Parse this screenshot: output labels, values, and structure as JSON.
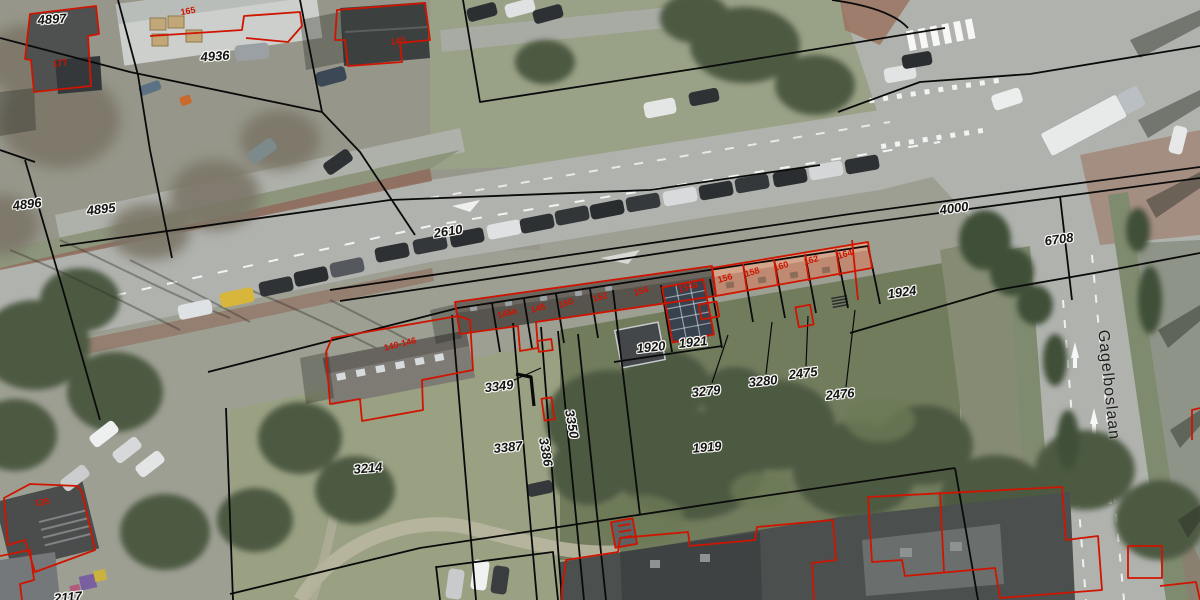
{
  "map": {
    "street_name": "Gagelboslaan",
    "street_name_rotation_deg": 84,
    "parcel_numbers": [
      {
        "text": "4897",
        "x": 52,
        "y": 19,
        "rot": -4
      },
      {
        "text": "4936",
        "x": 215,
        "y": 56,
        "rot": -4
      },
      {
        "text": "4896",
        "x": 27,
        "y": 204,
        "rot": -7
      },
      {
        "text": "4895",
        "x": 101,
        "y": 209,
        "rot": -7
      },
      {
        "text": "2610",
        "x": 448,
        "y": 231,
        "rot": -9
      },
      {
        "text": "4000",
        "x": 954,
        "y": 208,
        "rot": -8
      },
      {
        "text": "6708",
        "x": 1059,
        "y": 239,
        "rot": -8
      },
      {
        "text": "1924",
        "x": 902,
        "y": 292,
        "rot": -8
      },
      {
        "text": "1920",
        "x": 651,
        "y": 347,
        "rot": -6
      },
      {
        "text": "1921",
        "x": 693,
        "y": 342,
        "rot": -6
      },
      {
        "text": "3279",
        "x": 706,
        "y": 391,
        "rot": -6
      },
      {
        "text": "3280",
        "x": 763,
        "y": 381,
        "rot": -6
      },
      {
        "text": "2475",
        "x": 803,
        "y": 373,
        "rot": -7
      },
      {
        "text": "2476",
        "x": 840,
        "y": 394,
        "rot": -6
      },
      {
        "text": "1919",
        "x": 707,
        "y": 447,
        "rot": -5
      },
      {
        "text": "3349",
        "x": 499,
        "y": 386,
        "rot": -7
      },
      {
        "text": "3387",
        "x": 508,
        "y": 447,
        "rot": -6
      },
      {
        "text": "3386",
        "x": 546,
        "y": 452,
        "rot": 80
      },
      {
        "text": "3350",
        "x": 572,
        "y": 424,
        "rot": 80
      },
      {
        "text": "3214",
        "x": 368,
        "y": 468,
        "rot": -5
      },
      {
        "text": "2117",
        "x": 68,
        "y": 597,
        "rot": -5
      }
    ],
    "house_numbers": [
      {
        "text": "165",
        "x": 188,
        "y": 11,
        "rot": -10
      },
      {
        "text": "177",
        "x": 60,
        "y": 63,
        "rot": -8
      },
      {
        "text": "140",
        "x": 398,
        "y": 41,
        "rot": -10
      },
      {
        "text": "140-146",
        "x": 400,
        "y": 344,
        "rot": -14
      },
      {
        "text": "146a",
        "x": 507,
        "y": 313,
        "rot": -16
      },
      {
        "text": "148",
        "x": 538,
        "y": 308,
        "rot": -16
      },
      {
        "text": "150",
        "x": 566,
        "y": 303,
        "rot": -16
      },
      {
        "text": "152",
        "x": 600,
        "y": 297,
        "rot": -16
      },
      {
        "text": "154",
        "x": 641,
        "y": 291,
        "rot": -16
      },
      {
        "text": "154a",
        "x": 688,
        "y": 287,
        "rot": -16
      },
      {
        "text": "156",
        "x": 725,
        "y": 278,
        "rot": -16
      },
      {
        "text": "158",
        "x": 752,
        "y": 272,
        "rot": -16
      },
      {
        "text": "160",
        "x": 781,
        "y": 266,
        "rot": -16
      },
      {
        "text": "162",
        "x": 811,
        "y": 260,
        "rot": -16
      },
      {
        "text": "164",
        "x": 845,
        "y": 254,
        "rot": -16
      },
      {
        "text": "135",
        "x": 42,
        "y": 502,
        "rot": -8
      }
    ],
    "colors": {
      "parcel_boundary": "#0a0a0a",
      "building_outline": "#cf1400",
      "parcel_label_text": "#141414",
      "label_halo": "#f6f6f3",
      "asphalt": "#b0b2ae",
      "cycle_path": "#8f6a59",
      "grass": "#8d967c",
      "dense_vegetation": "#4d5a43",
      "terracotta_roof": "#c08a72"
    }
  }
}
